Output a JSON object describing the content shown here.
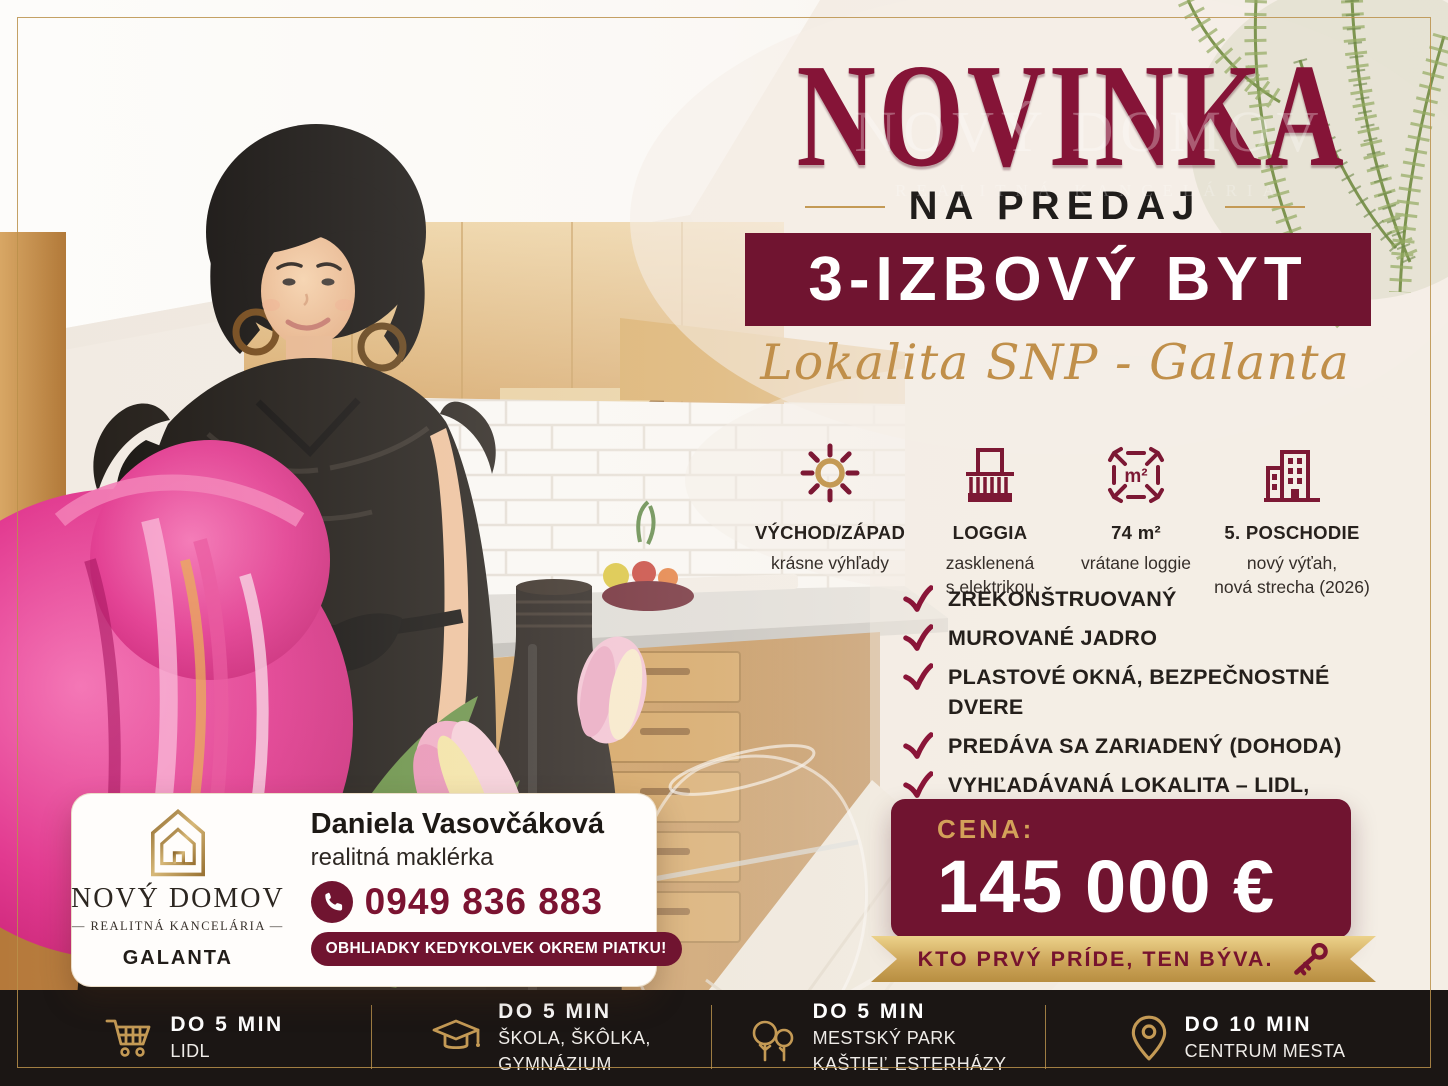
{
  "colors": {
    "maroon": "#701430",
    "maroonDeep": "#4f0d22",
    "gold": "#c49a55",
    "goldDark": "#a87f3e",
    "cream": "#f3ece4",
    "barBg": "#1b1614",
    "textDark": "#26201c"
  },
  "header": {
    "title": "NOVINKA",
    "subtitle": "NA PREDAJ",
    "banner": "3-IZBOVÝ BYT",
    "location": "Lokalita SNP - Galanta"
  },
  "watermark": {
    "line1": "NOVÝ DOMOV",
    "line2": "REALITNÁ KANCELÁRIA"
  },
  "features": [
    {
      "icon": "sun-icon",
      "title": "VÝCHOD/ZÁPAD",
      "lines": [
        "krásne výhľady"
      ]
    },
    {
      "icon": "balcony-icon",
      "title": "LOGGIA",
      "lines": [
        "zasklenená",
        "s elektrikou"
      ]
    },
    {
      "icon": "area-icon",
      "icon_label": "m²",
      "title": "74 m²",
      "lines": [
        "vrátane loggie"
      ]
    },
    {
      "icon": "building-icon",
      "title": "5. POSCHODIE",
      "lines": [
        "nový výťah,",
        "nová strecha (2026)"
      ]
    }
  ],
  "checklist": [
    "ZREKONŠTRUOVANÝ",
    "MUROVANÉ JADRO",
    "PLASTOVÉ OKNÁ, BEZPEČNOSTNÉ DVERE",
    "PREDÁVA SA ZARIADENÝ (DOHODA)",
    "VYHĽADÁVANÁ LOKALITA – LIDL, ŠKOLA, ŠKÔLKA, GYMNÁZIUM, PARK"
  ],
  "price": {
    "label": "CENA:",
    "value": "145 000 €"
  },
  "ribbon": {
    "text": "KTO PRVÝ PRÍDE, TEN BÝVA.",
    "icon": "key-icon"
  },
  "agency_card": {
    "agency_name": "NOVÝ DOMOV",
    "agency_tagline": "— REALITNÁ KANCELÁRIA —",
    "city": "GALANTA",
    "agent_name": "Daniela Vasovčáková",
    "agent_role": "realitná maklérka",
    "phone": "0949 836 883",
    "note": "OBHLIADKY KEDYKOLVEK OKREM PIATKU!"
  },
  "bottom_bar": [
    {
      "icon": "cart-icon",
      "title": "DO 5 MIN",
      "lines": [
        "LIDL"
      ]
    },
    {
      "icon": "graduation-cap-icon",
      "title": "DO 5 MIN",
      "lines": [
        "ŠKOLA, ŠKÔLKA,",
        "GYMNÁZIUM"
      ]
    },
    {
      "icon": "trees-icon",
      "title": "DO 5 MIN",
      "lines": [
        "MESTSKÝ PARK",
        "KAŠTIEĽ ESTERHÁZY"
      ]
    },
    {
      "icon": "location-pin-icon",
      "title": "DO 10 MIN",
      "lines": [
        "CENTRUM MESTA"
      ]
    }
  ]
}
